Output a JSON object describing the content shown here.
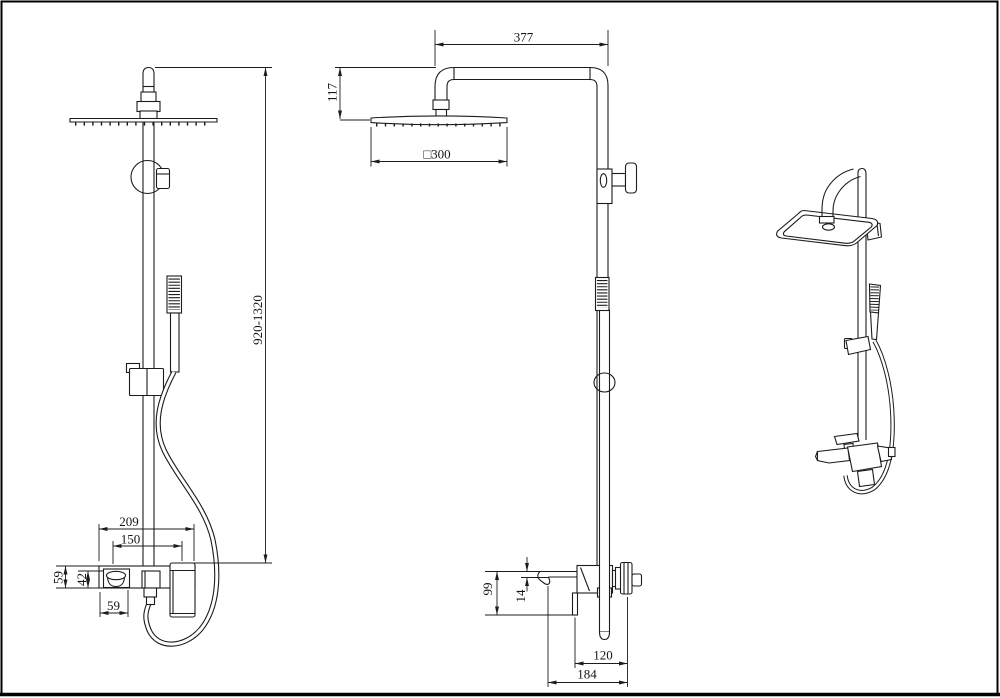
{
  "drawing": {
    "type": "technical-drawing",
    "subject": "exposed rain shower set with hand shower and wall mixer, three views",
    "colors": {
      "background": "#ffffff",
      "line": "#1c1c1c",
      "frame": "#000000"
    }
  },
  "dimensions": {
    "front_view": {
      "overall_height": "920-1320",
      "mixer_width": "209",
      "hole_spacing": "150",
      "body_height": "59",
      "spout_height": "42",
      "spout_width": "59"
    },
    "side_view": {
      "arm_reach": "377",
      "head_drop": "117",
      "head_size": "□300",
      "spout_drop": "99",
      "spout_thickness": "14",
      "body_depth": "120",
      "overall_depth": "184"
    }
  }
}
